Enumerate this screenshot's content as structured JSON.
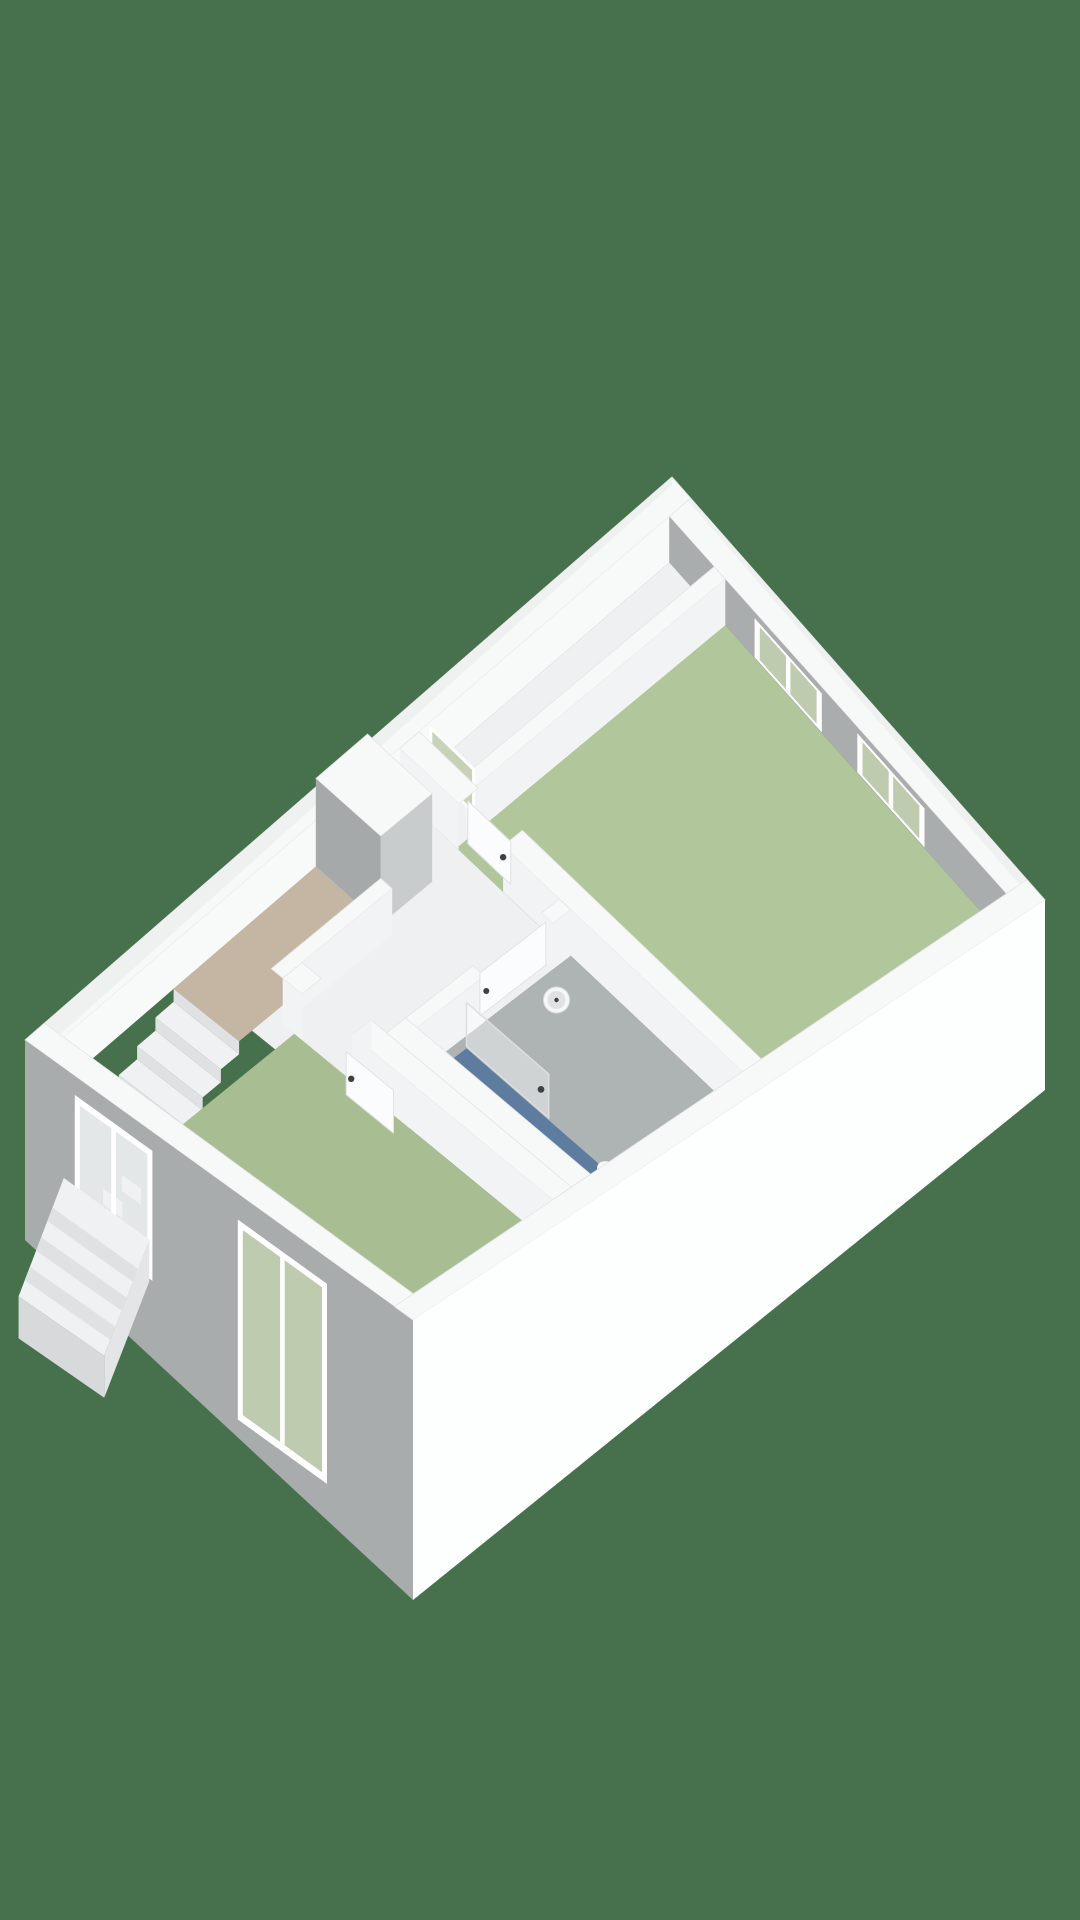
{
  "scene": {
    "description": "3D axonometric floor plan render of an upper storey, no visible text",
    "rooms": [
      {
        "name": "bedroom-top",
        "floor": "green",
        "windows": 2
      },
      {
        "name": "bedroom-bottom",
        "floor": "green",
        "windows": 1
      },
      {
        "name": "bathroom",
        "floor": "grey",
        "features": [
          "shower-area",
          "toilet",
          "washbasin",
          "glass-screen"
        ]
      },
      {
        "name": "hallway-landing",
        "floor": "white",
        "features": [
          "door-bedroom-top",
          "door-bedroom-bottom",
          "glass-door"
        ]
      },
      {
        "name": "stairwell",
        "floor": "beige",
        "features": [
          "staircase-down",
          "exterior-stair-wedge",
          "stair-window"
        ]
      },
      {
        "name": "duct-shaft",
        "floor": "white"
      }
    ]
  },
  "palette": {
    "background": "#47714D",
    "wall_top": "#F7F8F8",
    "wall_edge": "#E3E5E6",
    "rim_light": "#EFF1F1",
    "ne_interior": "#A9ADAE",
    "nw_interior": "#F8FAFA",
    "partition_lit": "#F2F3F4",
    "partition_shade": "#A5A9AA",
    "partition_mid": "#C9CCCD",
    "se_outer": "#FDFEFE",
    "sw_outer": "#A9ACAD",
    "floor_hall": "#EFF0F1",
    "floor_bed1": "#B2C69C",
    "floor_bed2": "#A8BD92",
    "floor_bath": "#AEB3B4",
    "floor_landing": "#C4B6A2",
    "floor_duct": "#E8EAEB",
    "shower_blue": "#5E7CA0",
    "glass_green": "#BFCBAE",
    "glass_grey": "#E4E7E7",
    "door_white": "#FBFCFD",
    "door_edge": "#E0E2E3",
    "step_white": "#F0F1F2",
    "riser_grey": "#DFE1E2",
    "handle_dark": "#3E4143",
    "fixture_white": "#F6F8F8",
    "fixture_inner": "#DFE2E3",
    "frame_white": "#FFFFFF",
    "wedge_side": "#E3E5E6",
    "wedge_end": "#D7D9DA"
  }
}
